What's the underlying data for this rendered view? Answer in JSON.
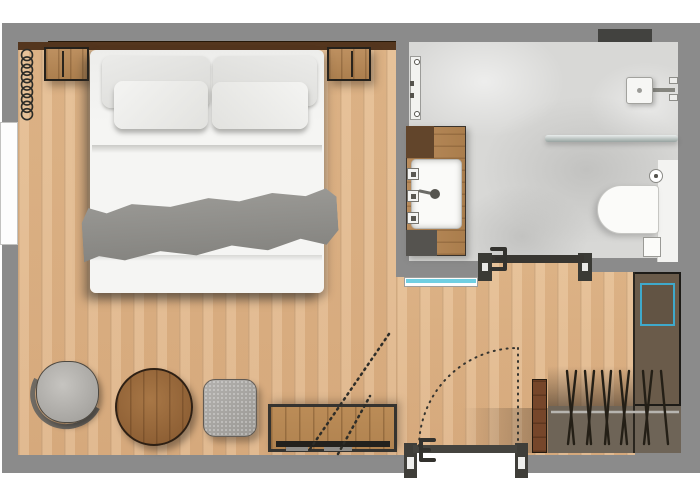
{
  "plan": {
    "type": "studio-hotel-room-floor-plan",
    "rooms": [
      "bedroom-living-area",
      "bathroom",
      "wardrobe-closet",
      "entry"
    ],
    "colors": {
      "plan_bg": "#8b8b8b",
      "wall_brown": "#54361e",
      "wall_line": "#261808",
      "tile": "#d8d8d6",
      "bed_white": "#f5f5f3",
      "runner": "#908f8b",
      "console_wood": "#b18350",
      "niche_brown": "#6a5b4a",
      "safe_teal": "#3fa9cb",
      "closet_floor": "#6e6457",
      "cabinet_brown": "#76462a",
      "window_cyan": "#6fcfe2",
      "dark_fill": "#42423f",
      "line_dark": "#2e2d28"
    },
    "furniture": {
      "bedroom": [
        "double-bed",
        "back-pillow-left",
        "back-pillow-right",
        "front-pillow-left",
        "front-pillow-right",
        "bed-runner",
        "nightstand-left",
        "nightstand-right",
        "radiator-coil",
        "exterior-window",
        "tub-armchair",
        "round-side-table",
        "ottoman",
        "tv-console",
        "tv",
        "tv-swivel-arc"
      ],
      "bathroom": [
        "vanity-counter",
        "under-sink-cabinet",
        "sink-basin",
        "faucet",
        "toiletry-items",
        "towel-rail",
        "wall-niche-vent",
        "shower-head",
        "shower-screen",
        "toilet-bowl",
        "toilet-cistern-ledge",
        "toilet-paper-holder",
        "waste-bin",
        "interior-glass-window"
      ],
      "closet": [
        "safe-with-teal-outline",
        "clothes-rail",
        "hangers",
        "tall-cabinet"
      ],
      "doors": [
        "entry-door-with-swing-arc",
        "bathroom-sliding-door"
      ]
    },
    "radiator": {
      "loops": 9,
      "cx": 27,
      "y_top": 55,
      "spacing": 7.4,
      "r": 5.5
    },
    "closet": {
      "rail": {
        "x1": 551,
        "x2": 679,
        "y": 412
      },
      "hanger_top_y": 371,
      "hanger_bottom_y": 444,
      "hangers": [
        {
          "x": 567,
          "dx": 7
        },
        {
          "x": 576,
          "dx": -8
        },
        {
          "x": 585,
          "dx": 6
        },
        {
          "x": 594,
          "dx": -7
        },
        {
          "x": 602,
          "dx": 7
        },
        {
          "x": 611,
          "dx": -6
        },
        {
          "x": 620,
          "dx": 7
        },
        {
          "x": 629,
          "dx": -8
        },
        {
          "x": 643,
          "dx": 6
        },
        {
          "x": 652,
          "dx": -8
        },
        {
          "x": 661,
          "dx": 7
        }
      ]
    },
    "entry_door": {
      "hinge_x": 518,
      "hinge_y": 447,
      "radius": 99
    },
    "tv_swivel_lines": [
      {
        "x1": 389,
        "y1": 334,
        "x2": 308,
        "y2": 452
      },
      {
        "x1": 338,
        "y1": 454,
        "x2": 370,
        "y2": 396
      }
    ]
  }
}
